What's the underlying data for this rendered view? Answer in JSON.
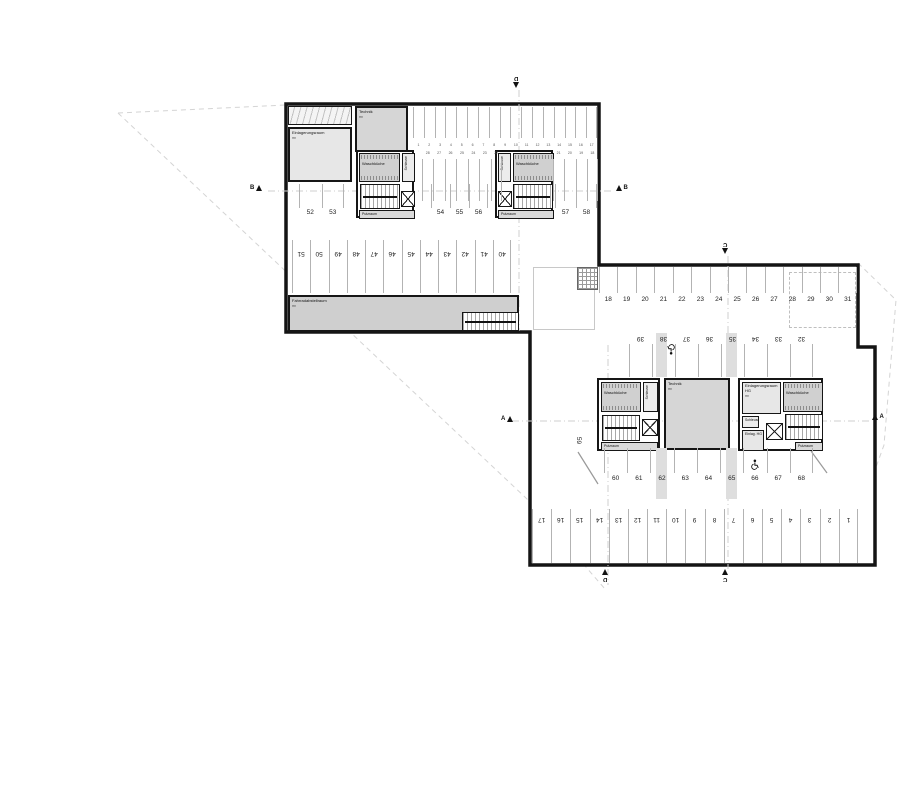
{
  "sections": {
    "a": "A",
    "b": "B",
    "c": "C",
    "d": "D"
  },
  "rooms": {
    "einlagerungsraum": {
      "label": "Einlagerungsraum",
      "area": "m²"
    },
    "technik_upper": {
      "label": "Technik",
      "area": "m²"
    },
    "technik_lower": {
      "label": "Technik",
      "area": "m²"
    },
    "waschkueche": {
      "label": "Waschküche",
      "area": "m²"
    },
    "schleuse": {
      "label": "Schleuse"
    },
    "putzraum": {
      "label": "Putzraum",
      "area": "m²"
    },
    "fahrradabstellraum": {
      "label": "Fahrradabstellraum",
      "area": "m²"
    },
    "einlagerungsraum_hg": {
      "label": "Einlagerungsraum HG",
      "area": "m²"
    },
    "einlag_hg": {
      "label": "Einlag. HG",
      "area": "m²"
    }
  },
  "stalls": {
    "upper_top": [
      "1",
      "2",
      "3",
      "4",
      "5",
      "6",
      "7",
      "8",
      "9",
      "10",
      "11",
      "12",
      "13",
      "14",
      "15",
      "16",
      "17"
    ],
    "upper_mid_left": [
      "28",
      "27",
      "26",
      "25",
      "24",
      "23",
      "22"
    ],
    "upper_mid_right": [
      "21",
      "20",
      "19",
      "18"
    ],
    "row_40_51": [
      "51",
      "50",
      "49",
      "48",
      "47",
      "46",
      "45",
      "44",
      "43",
      "42",
      "41",
      "40"
    ],
    "row_52_53": [
      "52",
      "53"
    ],
    "row_54_56": [
      "54",
      "55",
      "56"
    ],
    "row_57_58": [
      "57",
      "58"
    ],
    "row_18_31": [
      "18",
      "19",
      "20",
      "21",
      "22",
      "23",
      "24",
      "25",
      "26",
      "27",
      "28",
      "29",
      "30",
      "31"
    ],
    "row_32_39": [
      "39",
      "38",
      "37",
      "36",
      "35",
      "34",
      "33",
      "32"
    ],
    "row_60_68": [
      "60",
      "61",
      "62",
      "63",
      "64",
      "65",
      "66",
      "67",
      "68"
    ],
    "row_bottom": [
      "17",
      "16",
      "15",
      "14",
      "13",
      "12",
      "11",
      "10",
      "9",
      "8",
      "7",
      "6",
      "5",
      "4",
      "3",
      "2",
      "1"
    ],
    "stall_59": "59"
  },
  "colors": {
    "wall": "#141414",
    "dash": "#cfcfcf",
    "parcel": "#d4d4d4"
  }
}
